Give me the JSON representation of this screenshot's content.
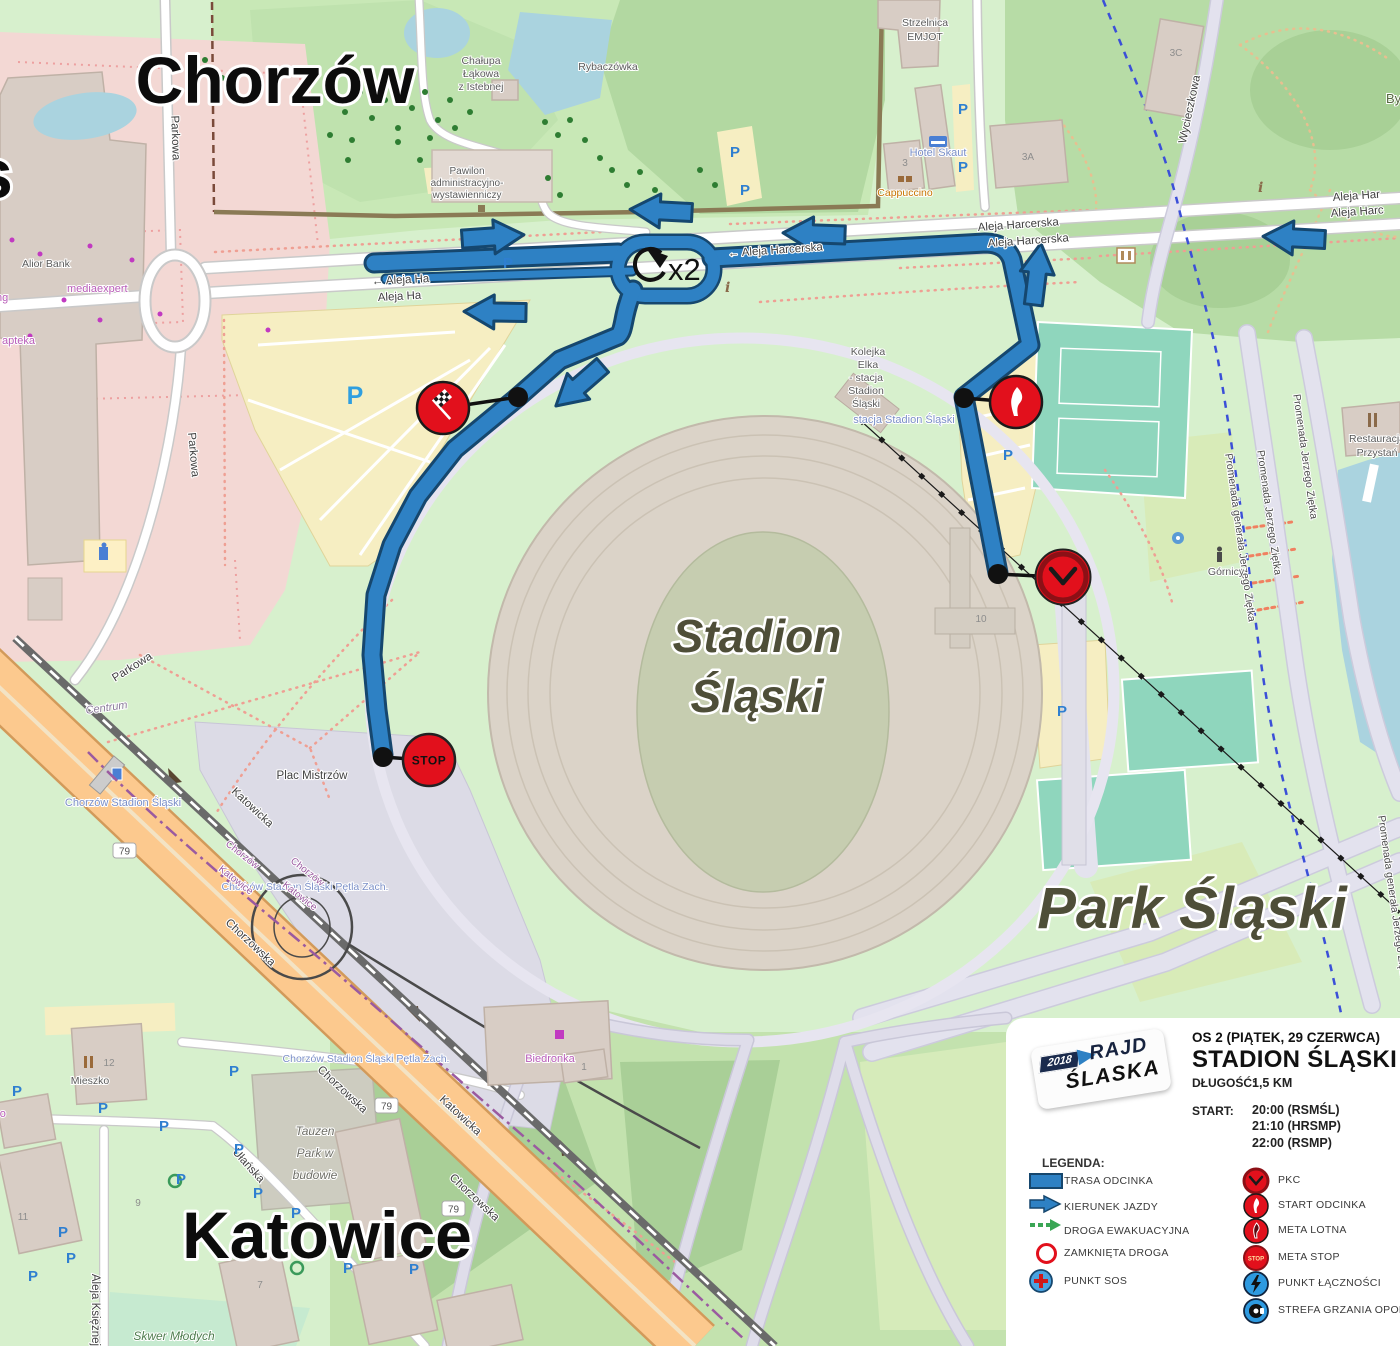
{
  "map": {
    "cities": {
      "chorzow": "Chorzów",
      "katowice": "Katowice",
      "edge_partial_s": "s",
      "edge_partial_by": "By"
    },
    "areas": {
      "park_slaski": "Park Śląski",
      "stadion_line1": "Stadion",
      "stadion_line2": "Śląski",
      "plac_mistrzow": "Plac Mistrzów",
      "skwer_mlodych": "Skwer Młodych",
      "centrum": "Centrum",
      "tauzen_line1": "Tauzen",
      "tauzen_line2": "Park w",
      "tauzen_line3": "budowie"
    },
    "streets": {
      "aleja_harcerska": "Aleja Harcerska",
      "aleja_harcerska_left": "← Aleja Harcerska",
      "aleja_ha_left_partial": "← Aleja Ha",
      "aleja_ha_partial": "Aleja Ha",
      "aleja_har_partial": "Aleja Har",
      "aleja_harc_partial": "Aleja Harc",
      "parkowa": "Parkowa",
      "katowicka": "Katowicka",
      "chorzowska": "Chorzowska",
      "ulanska": "Ułańska",
      "wycieczkowa": "Wycieczkowa",
      "aleja_ksieznej": "Aleja Księżnej",
      "promenada_jz": "Promenada Jerzego Ziętka",
      "promenada_gjz": "Promenada generała Jerzego Ziętka",
      "route_79": "79"
    },
    "pois": {
      "alior_bank": "Alior Bank",
      "mediaexpert": "mediaexpert",
      "apteka": "apteka",
      "carrefour_partial": "refour",
      "ng_partial": "ng",
      "naco_partial": "naco",
      "biedronka": "Biedronka",
      "mieszko": "Mieszko",
      "hotel_skaut": "Hotel Skaut",
      "cappuccino": "Cappuccino",
      "strzelnica1": "Strzelnica",
      "strzelnica2": "EMJOT",
      "chalupa1": "Chałupa",
      "chalupa2": "Łąkowa",
      "chalupa3": "z Istebnej",
      "rybaczowka": "Rybaczówka",
      "pawilon1": "Pawilon",
      "pawilon2": "administracyjno-",
      "pawilon3": "wystawienniczy",
      "restauracja1": "Restauracja",
      "restauracja2": "Przystań",
      "gornicy": "Górnicy",
      "kolejka1": "Kolejka",
      "kolejka2": "Elka",
      "kolejka3": "- stacja",
      "kolejka4": "Stadion",
      "kolejka5": "Śląski",
      "stacja_stadion": "stacja Stadion Śląski",
      "station_chorzow": "Chorzów Stadion Śląski",
      "petla_zach": "Chorzów Stadion Śląski Pętla Zach.",
      "boundary_chorzow": "Chorzów",
      "boundary_katowice": "Katowice",
      "info_i": "i"
    },
    "buildings": {
      "b1": "1",
      "b3": "3",
      "b3a": "3A",
      "b3c": "3C",
      "b7": "7",
      "b9": "9",
      "b10": "10",
      "b11": "11",
      "b12": "12"
    },
    "route": {
      "loop_times": "x2",
      "stop": "STOP",
      "parking_p": "P"
    }
  },
  "legend": {
    "logo": {
      "year": "2018",
      "line1": "RAJD",
      "line2": "ŚLASKA"
    },
    "title_line1": "OS 2 (PIĄTEK, 29 CZERWCA)",
    "title_line2": "STADION ŚLĄSKI",
    "length_label": "DŁUGOŚĆ:",
    "length_value": "1,5 KM",
    "start_label": "START:",
    "start_times": [
      "20:00 (RSMŚL)",
      "21:10 (HRSMP)",
      "22:00 (RSMP)"
    ],
    "legend_label": "LEGENDA:",
    "left": [
      {
        "icon": "route-bar-icon",
        "label": "TRASA ODCINKA"
      },
      {
        "icon": "arrow-icon",
        "label": "KIERUNEK JAZDY"
      },
      {
        "icon": "green-dashed-arrow-icon",
        "label": "DROGA EWAKUACYJNA"
      },
      {
        "icon": "red-ring-icon",
        "label": "ZAMKNIĘTA DROGA"
      },
      {
        "icon": "sos-cross-icon",
        "label": "PUNKT SOS"
      }
    ],
    "right": [
      {
        "icon": "clock-icon",
        "label": "PKC"
      },
      {
        "icon": "flame-flag-icon",
        "label": "START ODCINKA"
      },
      {
        "icon": "checkered-flame-icon",
        "label": "META LOTNA"
      },
      {
        "icon": "stop-icon",
        "label": "META STOP"
      },
      {
        "icon": "lightning-icon",
        "label": "PUNKT ŁĄCZNOŚCI"
      },
      {
        "icon": "tire-icon",
        "label": "STREFA GRZANIA OPON"
      }
    ]
  },
  "colors": {
    "route_blue": "#2e81c4",
    "route_outline": "#16476e",
    "marker_red": "#e2101c",
    "marker_ring_dark": "#8c1016",
    "evac_green": "#3aa655",
    "water": "#aad3df",
    "park_light": "#d7f0cd",
    "park_mid": "#c8e8b6",
    "forest": "#b2d8a1",
    "parking_cream": "#f6eec2",
    "retail_pink": "#f3d8d4",
    "plaza_lavender": "#dcdbe6",
    "stadium_tan": "#dbd3c8",
    "road_orange": "#fcc98e",
    "court_teal": "#8fd6bd"
  }
}
